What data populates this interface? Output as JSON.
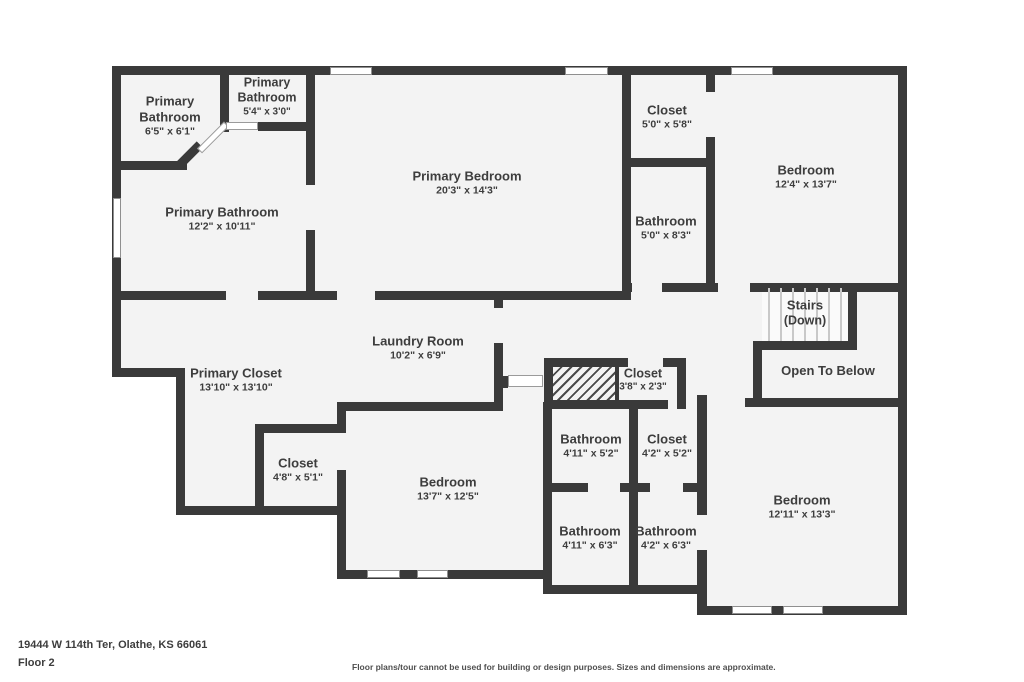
{
  "rooms": [
    {
      "name": "Primary Bathroom",
      "dims": "6'5\" x 6'1\""
    },
    {
      "name": "Primary Bathroom",
      "dims": "5'4\" x 3'0\""
    },
    {
      "name": "Primary Bathroom",
      "dims": "12'2\" x 10'11\""
    },
    {
      "name": "Primary Bedroom",
      "dims": "20'3\" x 14'3\""
    },
    {
      "name": "Closet",
      "dims": "5'0\" x 5'8\""
    },
    {
      "name": "Bathroom",
      "dims": "5'0\" x 8'3\""
    },
    {
      "name": "Bedroom",
      "dims": "12'4\" x 13'7\""
    },
    {
      "name": "Stairs",
      "dims": "(Down)"
    },
    {
      "name": "Open To Below",
      "dims": ""
    },
    {
      "name": "Primary Closet",
      "dims": "13'10\" x 13'10\""
    },
    {
      "name": "Laundry Room",
      "dims": "10'2\" x 6'9\""
    },
    {
      "name": "Closet",
      "dims": "3'8\" x 2'3\""
    },
    {
      "name": "Closet",
      "dims": "4'8\" x 5'1\""
    },
    {
      "name": "Bedroom",
      "dims": "13'7\" x 12'5\""
    },
    {
      "name": "Bathroom",
      "dims": "4'11\" x 5'2\""
    },
    {
      "name": "Closet",
      "dims": "4'2\" x 5'2\""
    },
    {
      "name": "Bathroom",
      "dims": "4'11\" x 6'3\""
    },
    {
      "name": "Bathroom",
      "dims": "4'2\" x 6'3\""
    },
    {
      "name": "Bedroom",
      "dims": "12'11\" x 13'3\""
    }
  ],
  "footer": {
    "address": "19444 W 114th Ter, Olathe, KS 66061",
    "floor": "Floor 2",
    "disclaimer": "Floor plans/tour cannot be used for building or design purposes. Sizes and dimensions are approximate."
  },
  "colors": {
    "wall": "#3a3a3a",
    "floor": "#f3f3f3",
    "text": "#3d3d3d"
  }
}
